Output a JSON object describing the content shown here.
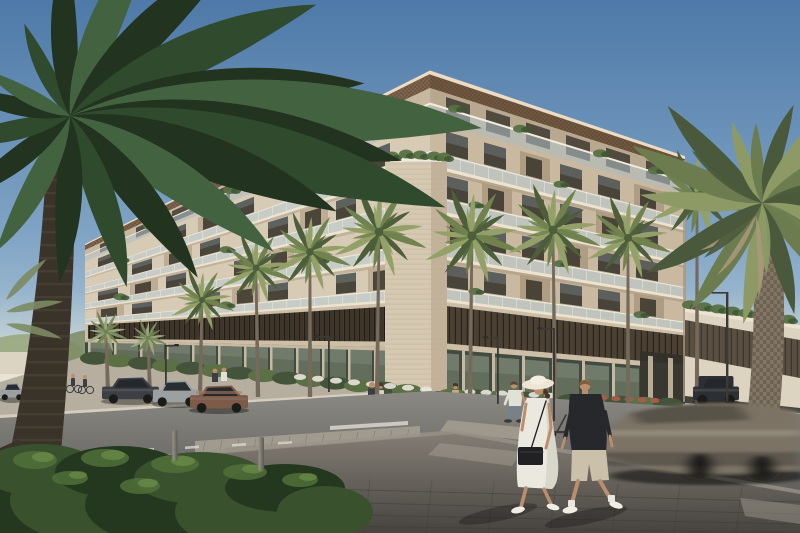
{
  "scene": {
    "type": "architectural-exterior-rendering",
    "subject": "corner apartment building with palm-lined street",
    "time_of_day": "day",
    "weather": "clear"
  },
  "objects": {
    "parked_cars": 5,
    "parked_suv": 1,
    "moving_cars": 1,
    "pedestrians_foreground": 3,
    "pedestrians_background": 5,
    "cyclists": 2,
    "street_palms": 10,
    "foreground_palms": 2,
    "street_lamps": 5,
    "bollards": 2,
    "scooters": 1
  },
  "palette": {
    "sky_top": "#4e79a8",
    "sky_mid": "#7fa3c4",
    "sky_low": "#c6d7de",
    "haze": "#e8e4d6",
    "bg_trees": "#9aa77f",
    "bg_trees_dark": "#7c8b63",
    "bg_bldg": "#ded6c6",
    "fence": "#eae4d6",
    "facade_left": "#d7cbb6",
    "facade_left_dk": "#b9a88e",
    "facade_right": "#c9b9a1",
    "facade_right_dk": "#a9977e",
    "fascia": "#7c634d",
    "fascia_r": "#6f573f",
    "fascia_dot": "#523d2d",
    "fascia_edge": "#ecdcc3",
    "slab": "#ece3d0",
    "soffit": "#8e7c64",
    "wall_pent_l": "#c8b8a1",
    "wall_pent_r": "#b9a890",
    "win_dark": "#3e3a30",
    "win_glass": "#8fa6b6",
    "bal_glass": "#b9cdd6",
    "bal_tick": "#f4efe2",
    "rail": "#f2ecdc",
    "plant_dk": "#3f5634",
    "plant_md": "#567042",
    "plant_lt": "#6f8a4c",
    "pier": "#d6c9b2",
    "pier_side": "#c2b29a",
    "pier_line": "#bfae94",
    "louv_a": "#3d352a",
    "louv_b": "#211c16",
    "louv_hl": "#5c4e3e",
    "louv_a2": "#4a4034",
    "louv_b2": "#2a241d",
    "louv_hl2": "#6a5b48",
    "louv_frame": "#cdbfa7",
    "store_glass": "#66715f",
    "store_dark": "#434b40",
    "store_mull": "#c6b9a2",
    "store_lt": "#8b968a",
    "entry_dark": "#32302a",
    "wing": "#ddd3c1",
    "hedge": "#5c7045",
    "hedge_dk": "#44543a",
    "flower_w": "#e9e6dc",
    "flower_r": "#b25a4c",
    "walk_far": "#b6afa0",
    "curb": "#d8d2c2",
    "road_a": "#8b8984",
    "road_b": "#615f5b",
    "cross": "#a59e92",
    "ramp": "#95907f",
    "dash": "#d9d6cc",
    "walk_a": "#837d74",
    "walk_b": "#474440",
    "walk_edge": "#9a9489",
    "joint": "#3c3935",
    "bush_dk": "#24381f",
    "bush_md": "#39512c",
    "bush_lt": "#50703a",
    "bush_hl": "#6d8f4a",
    "palmL_dk": "#22331f",
    "palmL_md": "#2f4a2c",
    "palmL_lt": "#436340",
    "trunkL": "#3a332a",
    "trunkL_hl": "#544939",
    "palm_lt": "#93a169",
    "palm_md": "#70824d",
    "palm_dk": "#4d5e3a",
    "trunk": "#75695a",
    "palmR_lt": "#8d9a66",
    "palmR_md": "#6c7c4f",
    "palmR_dk": "#4a593b",
    "palmR_dry": "#a9987a",
    "trunkR": "#6d6253",
    "trunkR_pat": "#948871",
    "lawn": "#7d8f5a",
    "car_dk": "#3c4045",
    "car_glass": "#24272b",
    "car_silver": "#9ba0a2",
    "car_silver2": "#8f9394",
    "car_bronze": "#7e5b49",
    "car_bronze_hl": "#a37a5e",
    "suv": "#2c3034",
    "tire": "#1b1b19",
    "mcar": "#7b7365",
    "mcar_dk": "#4d4841",
    "mcar_glass": "#565047",
    "mcar_hl": "#a69d8e",
    "lamp": "#3b3a35",
    "lamp_head": "#2e2d29",
    "metal_a": "#9a968c",
    "metal_b": "#5b5850",
    "skin": "#bb8e6e",
    "w_hat": "#ede6d5",
    "w_hat_hl": "#f4eee0",
    "w_hat_sh": "#c9c0ab",
    "w_dress": "#ebe8df",
    "w_dress_sh": "#d2cec0",
    "w_hair": "#4a3529",
    "bag": "#212124",
    "shoe_w": "#f0ede4",
    "m_shirt": "#26282c",
    "m_shorts": "#cbc1ab",
    "m_hair": "#7d5f42",
    "sock": "#e8e6df",
    "ws_shirt": "#e2e1d8",
    "ws_jeans": "#75818b",
    "ws_hair": "#5a4632",
    "tan_top": "#c8a87e",
    "tan_skirt": "#cbb49a",
    "stand_dk": "#3a3d42",
    "stand_pants": "#55504a",
    "stand_dress": "#d9cfc0",
    "shadow": "#000000"
  }
}
